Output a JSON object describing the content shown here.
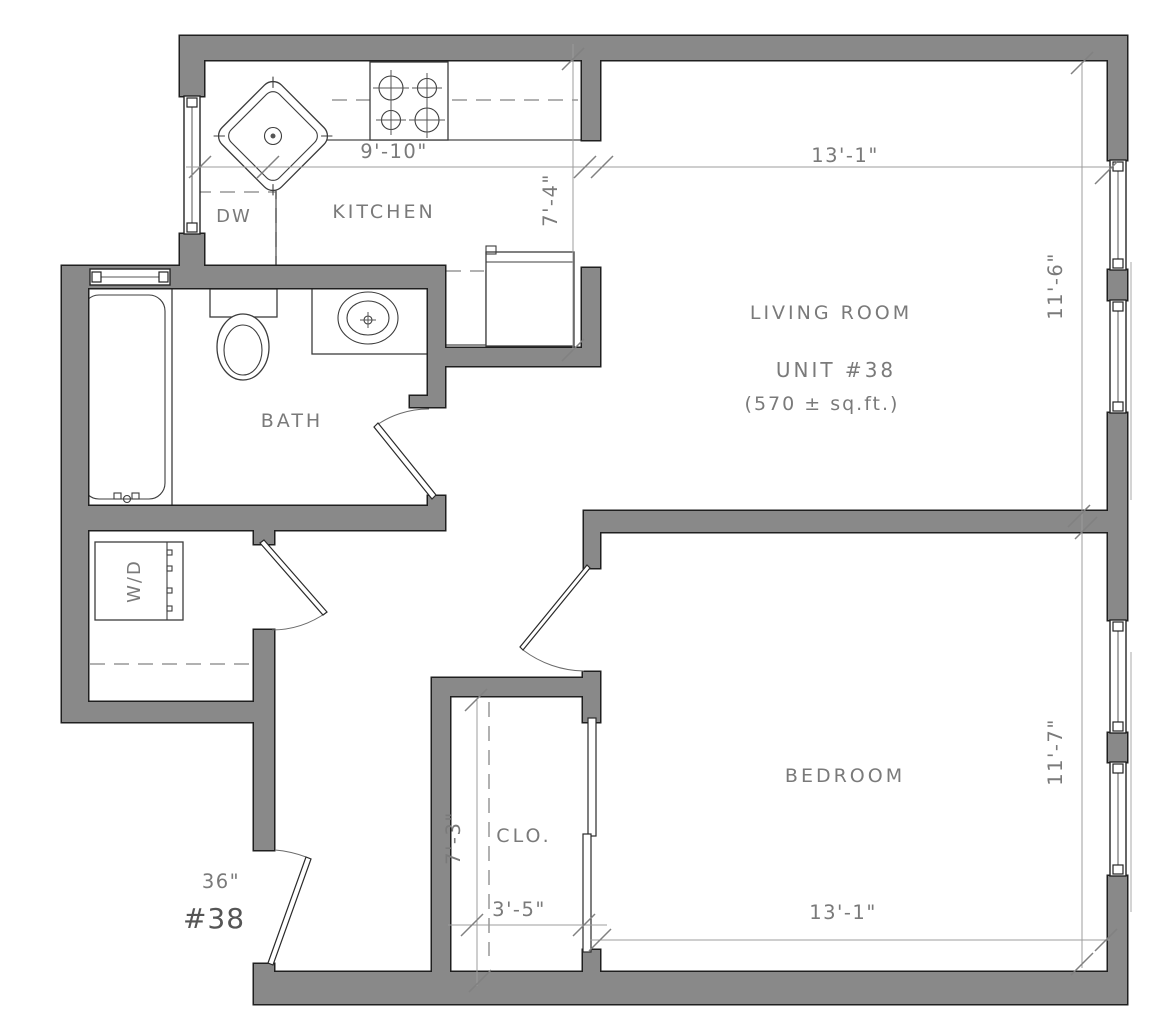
{
  "unit": {
    "title": "UNIT #38",
    "area": "(570 ± sq.ft.)",
    "number": "#38",
    "entry_door_width": "36\""
  },
  "kitchen": {
    "name": "KITCHEN",
    "dishwasher": "DW",
    "width": "9'-10\"",
    "depth": "7'-4\""
  },
  "living_room": {
    "name": "LIVING ROOM",
    "width": "13'-1\"",
    "depth": "11'-6\""
  },
  "bath": {
    "name": "BATH"
  },
  "laundry": {
    "washer_dryer": "W/D"
  },
  "bedroom": {
    "name": "BEDROOM",
    "width": "13'-1\"",
    "depth": "11'-7\""
  },
  "closet": {
    "name": "CLO.",
    "depth": "7'-3\"",
    "width": "3'-5\""
  },
  "colors": {
    "wall_fill": "#898989",
    "wall_stroke": "#1f1f1f",
    "label_text": "#7a7a7a",
    "dim_line": "#9c9c9c",
    "fixture_line": "#3c3c3c"
  }
}
